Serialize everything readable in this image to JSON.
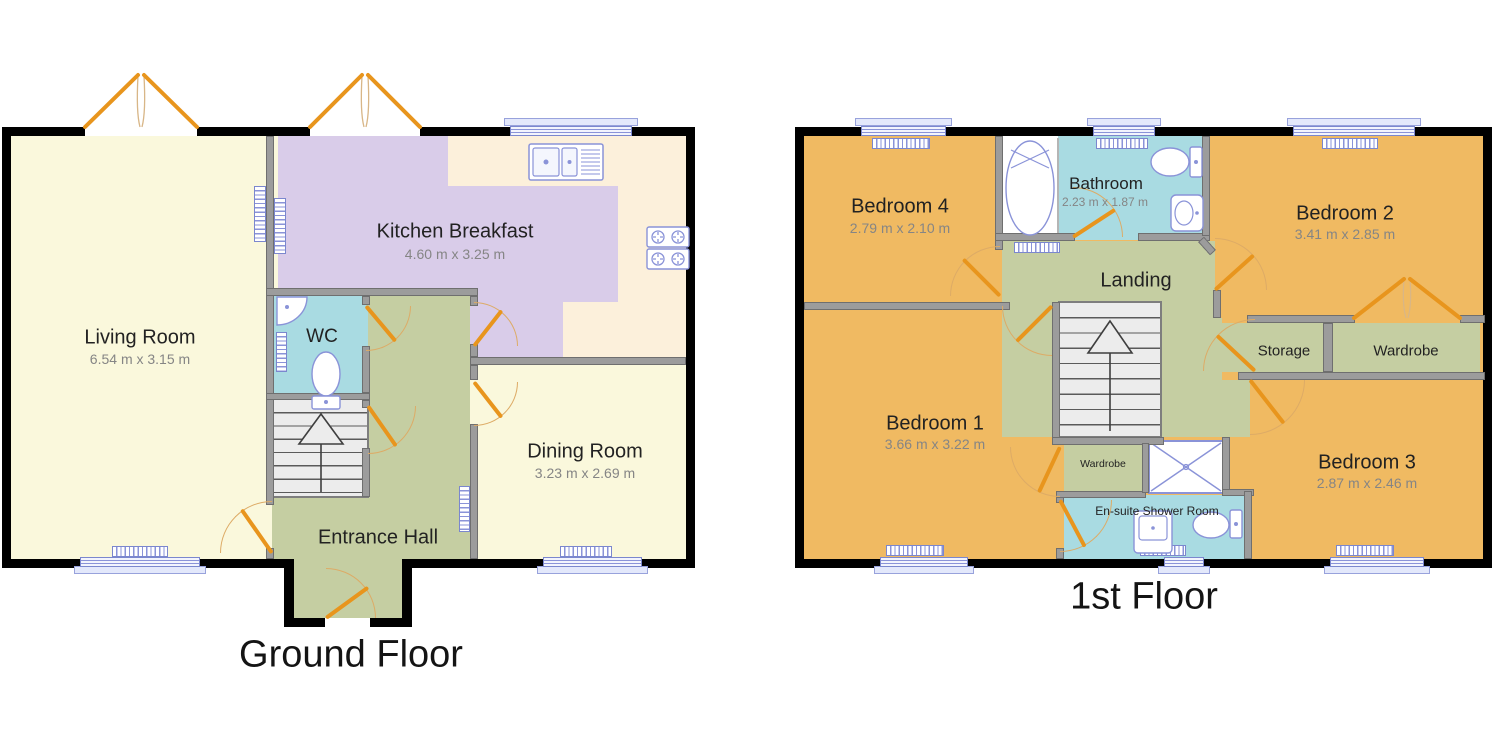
{
  "document_type": "floorplan",
  "colors": {
    "room_yellow": "#faf8dc",
    "room_lavender": "#d9cce9",
    "room_cream": "#fcf0db",
    "room_teal": "#a9dbe2",
    "room_green": "#c5cea2",
    "room_orange": "#f0ba62",
    "door_orange": "#e8951d",
    "window_blue": "#7b87ce",
    "wall_black": "#000000",
    "wall_gray": "#9c9c9c"
  },
  "floors": [
    {
      "title": "Ground Floor",
      "rooms": [
        {
          "id": "living-room",
          "label": "Living Room",
          "dims": "6.54 m x 3.15 m"
        },
        {
          "id": "kitchen-breakfast",
          "label": "Kitchen Breakfast",
          "dims": "4.60 m x 3.25 m"
        },
        {
          "id": "wc",
          "label": "WC",
          "dims": ""
        },
        {
          "id": "dining-room",
          "label": "Dining Room",
          "dims": "3.23 m x 2.69 m"
        },
        {
          "id": "entrance-hall",
          "label": "Entrance Hall",
          "dims": ""
        }
      ]
    },
    {
      "title": "1st Floor",
      "rooms": [
        {
          "id": "bedroom-4",
          "label": "Bedroom 4",
          "dims": "2.79 m x 2.10 m"
        },
        {
          "id": "bathroom",
          "label": "Bathroom",
          "dims": "2.23 m x 1.87 m"
        },
        {
          "id": "bedroom-2",
          "label": "Bedroom 2",
          "dims": "3.41 m x 2.85 m"
        },
        {
          "id": "landing",
          "label": "Landing",
          "dims": ""
        },
        {
          "id": "storage",
          "label": "Storage",
          "dims": ""
        },
        {
          "id": "wardrobe",
          "label": "Wardrobe",
          "dims": ""
        },
        {
          "id": "bedroom-1",
          "label": "Bedroom 1",
          "dims": "3.66 m x 3.22 m"
        },
        {
          "id": "wardrobe-small",
          "label": "Wardrobe",
          "dims": ""
        },
        {
          "id": "en-suite",
          "label": "En-suite Shower Room",
          "dims": ""
        },
        {
          "id": "bedroom-3",
          "label": "Bedroom 3",
          "dims": "2.87 m x 2.46 m"
        }
      ]
    }
  ]
}
